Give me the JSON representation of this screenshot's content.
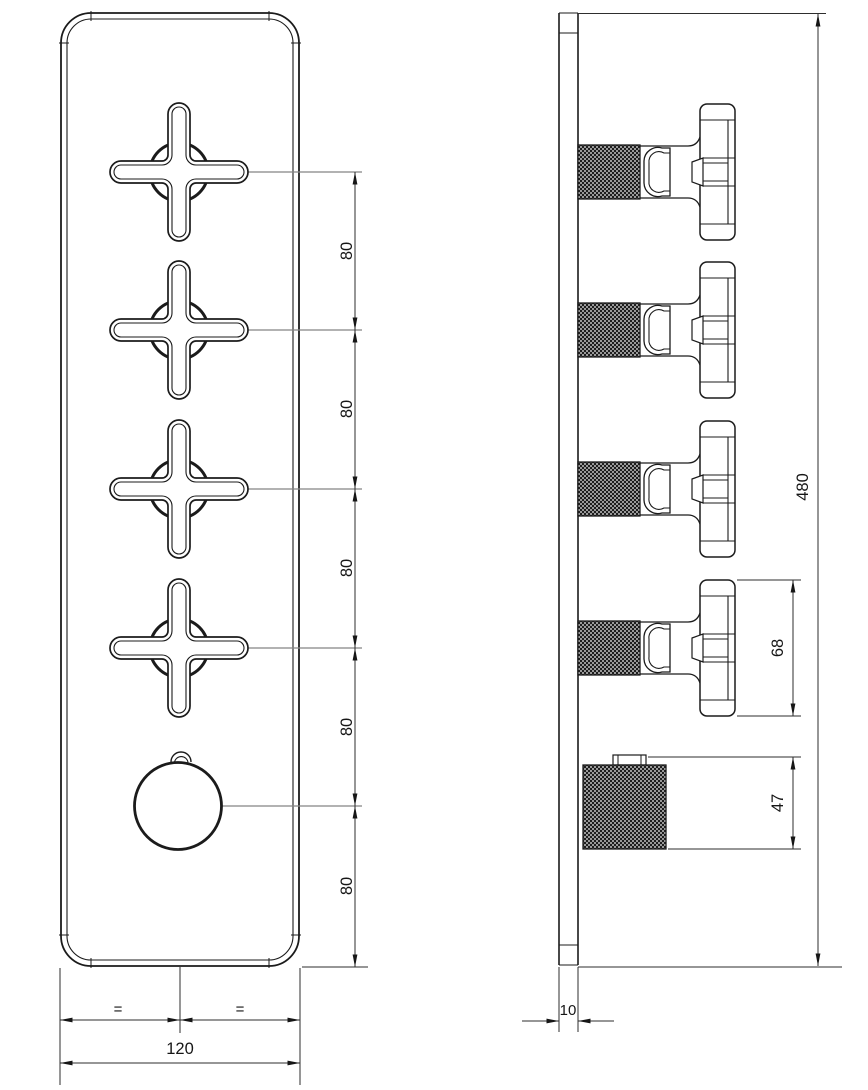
{
  "drawing": {
    "type": "technical-dimension-drawing",
    "subject": "wall-mounted 5-control thermostatic shower valve trim plate, front and side views",
    "front_view": {
      "spacing_dims": [
        "80",
        "80",
        "80",
        "80",
        "80"
      ],
      "equal_dims": [
        "=",
        "="
      ],
      "width_dim": "120"
    },
    "side_view": {
      "height_dim": "480",
      "handle_height_dim": "68",
      "knob_height_dim": "47",
      "plate_thickness_dim": "10"
    },
    "colors": {
      "outline": "#1b1b1b",
      "dimension_line": "#2e2e2e",
      "leader_line": "#858585",
      "background": "#ffffff"
    }
  }
}
